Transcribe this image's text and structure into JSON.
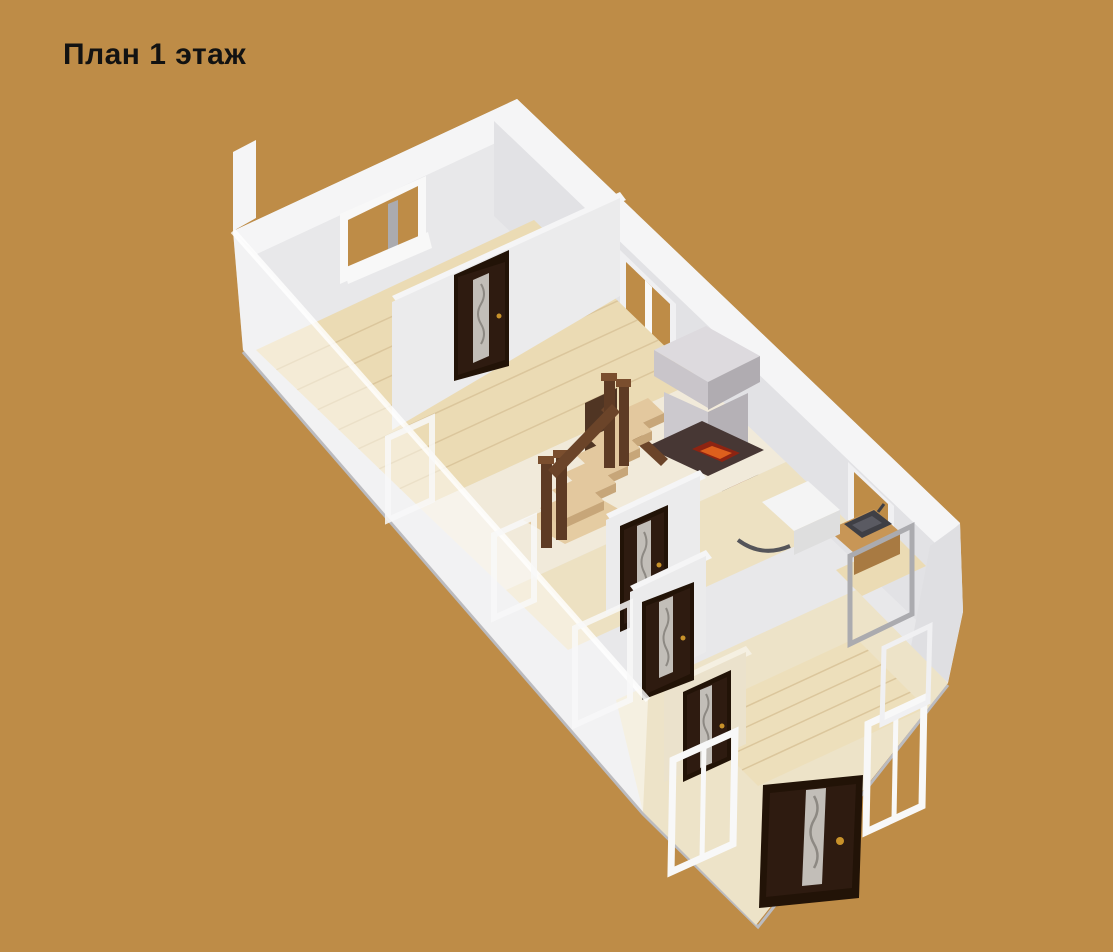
{
  "title": "План 1 этаж",
  "colors": {
    "background": "#BE8C47",
    "title_color": "#121212",
    "wall_face": "#E8E8EA",
    "wall_top": "#F5F5F6",
    "wall_side": "#E2E2E5",
    "wall_inner": "#EBEBEC",
    "wall_shade": "#DFDFE2",
    "slab_edge": "#BBBBBF",
    "floor_maple": "#EBDBB4",
    "plank_line": "#DBC69C",
    "floor_hall": "#F1EADA",
    "floor_cream": "#EDE1C2",
    "porch_wall": "#EDE3C8",
    "porch_wall_face": "#EBE2CC",
    "porch_wall_top": "#F5F0E2",
    "porch_floor": "#EDDFBB",
    "door_leaf": "#2E1B10",
    "door_frame": "#221307",
    "door_glass": "#C2BEB8",
    "door_wave": "#8D8983",
    "handle_gold": "#C8922A",
    "stair_tread": "#E3C89E",
    "stair_side": "#C7A679",
    "stair_rail": "#6B4429",
    "stair_post": "#5E3B24",
    "stair_cap": "#7A4E2E",
    "stair_panel": "#503523",
    "stair_landing": "#E5CCA2",
    "stove_top": "#DDDADE",
    "stove_left": "#C9C5CA",
    "stove_right": "#B0ACB1",
    "stove_body_l": "#CCC9CE",
    "stove_body_r": "#B5B1B6",
    "stove_base": "#473734",
    "fire_dark": "#8E2412",
    "fire_bright": "#DD5F1D",
    "doorway_dark": "#2F2320",
    "fridge_red": "#7A1616",
    "cooker_white": "#EFEFEF",
    "cooker_ring": "#9B9B9D",
    "sink_dark": "#3F3F45",
    "sink_inner": "#5A5A62",
    "counter_wood": "#C89656",
    "counter_wood_front": "#A87A42",
    "counter_white": "#F4F4F4",
    "counter_white_front": "#DEDEDE",
    "basin_rim": "#55555A",
    "window_frame_white": "#F8F8F8",
    "window_frame_light": "#F0F0F2",
    "window_mullion": "#ABABAF",
    "ghost_wall": "rgba(255,255,255,0.45)",
    "ghost_edge": "rgba(255,255,255,0.8)"
  },
  "objects": [
    "staircase",
    "masonry-stove",
    "interior-door",
    "entrance-door",
    "window",
    "kitchen-sink",
    "refrigerator",
    "cooker",
    "counter",
    "porch-window"
  ]
}
